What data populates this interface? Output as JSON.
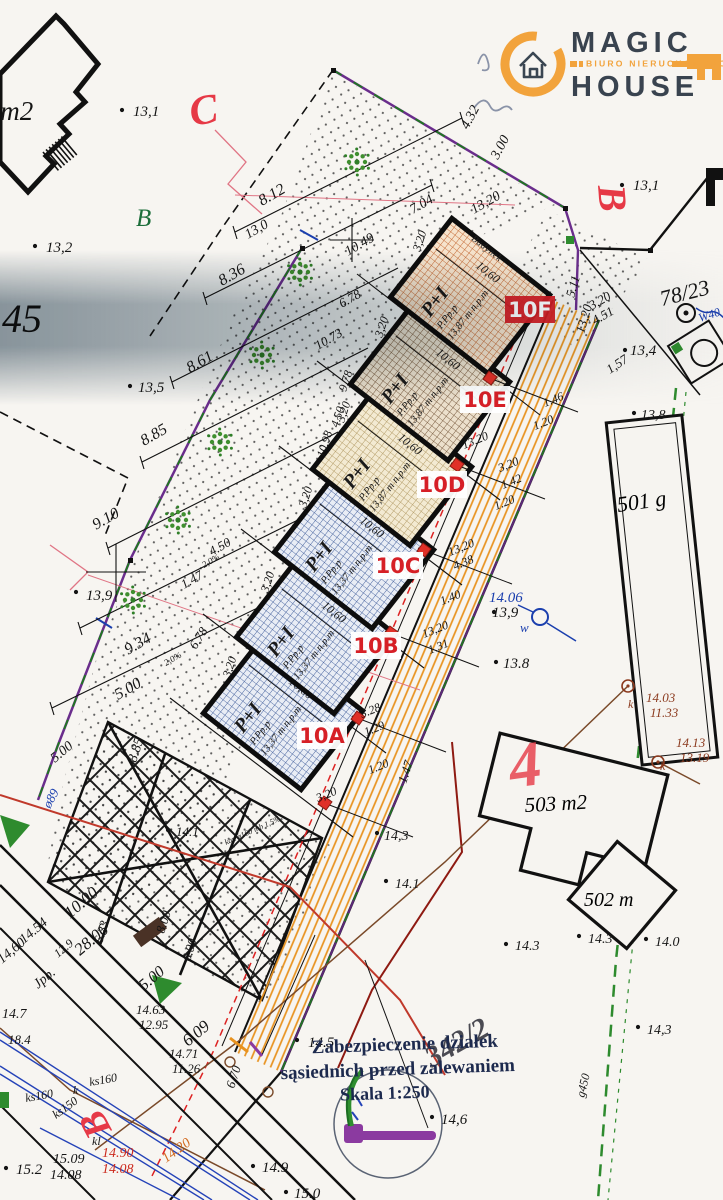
{
  "logo": {
    "word1": "MAGIC",
    "word2": "HOUSE",
    "tagline": "BIURO NIERUCHOMOŚCI"
  },
  "legend": {
    "line1": "Zabezpieczenie działek",
    "line2": "sąsiednich przed zalewaniem",
    "line3": "Skala 1:250"
  },
  "marker": "4",
  "buildings": {
    "b501": "501 g",
    "b503": "503 m2",
    "b502": "502 m"
  },
  "plot_common": {
    "storeys": "P+I",
    "code": "P.Pp.p",
    "building": "Budynek"
  },
  "plots": [
    {
      "id": "10A",
      "label": "10A",
      "cx": 283,
      "cy": 712,
      "pat": "blue",
      "elev": "13,37 m n.p.m",
      "depth": "10,60",
      "bx": 322,
      "by": 737,
      "ex": 325,
      "ey": 803,
      "inv": false
    },
    {
      "id": "10B",
      "label": "10B",
      "cx": 316,
      "cy": 636,
      "pat": "blue",
      "elev": "13,37 m n.p.m",
      "depth": "10,60",
      "bx": 376,
      "by": 647,
      "ex": 358,
      "ey": 718,
      "inv": false
    },
    {
      "id": "10C",
      "label": "10C",
      "cx": 354,
      "cy": 551,
      "pat": "blue",
      "elev": "13,37 m n.p.m",
      "depth": "10,60",
      "bx": 398,
      "by": 567,
      "ex": 391,
      "ey": 633,
      "inv": false
    },
    {
      "id": "10D",
      "label": "10D",
      "cx": 392,
      "cy": 468,
      "pat": "tan",
      "elev": "13,87 m n.p.m",
      "depth": "10,60",
      "bx": 442,
      "by": 486,
      "ex": 424,
      "ey": 550,
      "inv": false
    },
    {
      "id": "10E",
      "label": "10E",
      "cx": 430,
      "cy": 383,
      "pat": "brown",
      "elev": "13,87 m n.p.m",
      "depth": "10,60",
      "bx": 485,
      "by": 401,
      "ex": 457,
      "ey": 465,
      "inv": false
    },
    {
      "id": "10F",
      "label": "10F",
      "cx": 470,
      "cy": 296,
      "pat": "orange",
      "elev": "13,87 m n.p.m",
      "depth": "10,60",
      "bx": 530,
      "by": 311,
      "ex": 490,
      "ey": 378,
      "inv": true
    }
  ],
  "points": [
    [
      122,
      110
    ],
    [
      35,
      246
    ],
    [
      622,
      185
    ],
    [
      130,
      386
    ],
    [
      76,
      592
    ],
    [
      496,
      662
    ],
    [
      168,
      830
    ],
    [
      377,
      833
    ],
    [
      386,
      881
    ],
    [
      506,
      944
    ],
    [
      579,
      936
    ],
    [
      646,
      939
    ],
    [
      638,
      1027
    ],
    [
      297,
      1040
    ],
    [
      432,
      1117
    ],
    [
      253,
      1166
    ],
    [
      286,
      1192
    ],
    [
      6,
      1168
    ],
    [
      625,
      350
    ],
    [
      634,
      413
    ],
    [
      494,
      612
    ]
  ],
  "annotations": [
    {
      "t": "8 m2",
      "x": -20,
      "y": 120,
      "s": 27
    },
    {
      "t": "13,1",
      "x": 133,
      "y": 116,
      "s": 15
    },
    {
      "t": "C",
      "x": 192,
      "y": 126,
      "s": 42,
      "c": "#e63946",
      "r": -10,
      "b": 1
    },
    {
      "t": "B",
      "x": 136,
      "y": 226,
      "s": 25,
      "c": "#1c6e3a"
    },
    {
      "t": "13,2",
      "x": 46,
      "y": 252,
      "s": 15
    },
    {
      "t": "45",
      "x": 2,
      "y": 332,
      "s": 40
    },
    {
      "t": "8.12",
      "x": 262,
      "y": 206,
      "r": -30,
      "s": 16
    },
    {
      "t": "13,0",
      "x": 248,
      "y": 239,
      "r": -30,
      "s": 14
    },
    {
      "t": "10.49",
      "x": 348,
      "y": 256,
      "r": -30,
      "s": 14
    },
    {
      "t": "7.04",
      "x": 413,
      "y": 214,
      "r": -30,
      "s": 14
    },
    {
      "t": "13,20",
      "x": 474,
      "y": 214,
      "r": -30,
      "s": 14
    },
    {
      "t": "4.32",
      "x": 468,
      "y": 130,
      "r": -62,
      "s": 14
    },
    {
      "t": "3.00",
      "x": 498,
      "y": 160,
      "r": -62,
      "s": 14
    },
    {
      "t": "8.36",
      "x": 222,
      "y": 286,
      "r": -30,
      "s": 16
    },
    {
      "t": "6.78",
      "x": 342,
      "y": 308,
      "r": -30,
      "s": 13
    },
    {
      "t": "8.61",
      "x": 190,
      "y": 373,
      "r": -30,
      "s": 16
    },
    {
      "t": "10.73",
      "x": 318,
      "y": 350,
      "r": -30,
      "s": 13
    },
    {
      "t": "9.78",
      "x": 346,
      "y": 392,
      "r": -72,
      "s": 12
    },
    {
      "t": "4.50",
      "x": 338,
      "y": 428,
      "r": -72,
      "s": 12
    },
    {
      "t": "10.98",
      "x": 324,
      "y": 458,
      "r": -72,
      "s": 12
    },
    {
      "t": "8.85",
      "x": 144,
      "y": 446,
      "r": -30,
      "s": 16
    },
    {
      "t": "4.50",
      "x": 212,
      "y": 556,
      "r": -30,
      "s": 13
    },
    {
      "t": "1.47",
      "x": 184,
      "y": 589,
      "r": -30,
      "s": 13
    },
    {
      "t": "9.10",
      "x": 96,
      "y": 530,
      "r": -30,
      "s": 16
    },
    {
      "t": "13,9",
      "x": 86,
      "y": 600,
      "s": 15
    },
    {
      "t": "2,0%",
      "x": 204,
      "y": 568,
      "r": -30,
      "s": 9
    },
    {
      "t": "2,0%",
      "x": 166,
      "y": 666,
      "r": -30,
      "s": 9
    },
    {
      "t": "6.78",
      "x": 196,
      "y": 650,
      "r": -58,
      "s": 13
    },
    {
      "t": "9.34",
      "x": 128,
      "y": 655,
      "r": -30,
      "s": 16
    },
    {
      "t": "5.00",
      "x": 118,
      "y": 700,
      "r": -30,
      "s": 16
    },
    {
      "t": "13,5",
      "x": 138,
      "y": 392,
      "s": 15
    },
    {
      "t": "B",
      "x": 598,
      "y": 186,
      "s": 40,
      "c": "#e63946",
      "r": 85,
      "b": 1
    },
    {
      "t": "13,1",
      "x": 633,
      "y": 190,
      "s": 15
    },
    {
      "t": "78/23",
      "x": 662,
      "y": 306,
      "r": -14,
      "s": 22
    },
    {
      "t": "W40",
      "x": 700,
      "y": 322,
      "r": -18,
      "s": 12,
      "c": "#1b3fae"
    },
    {
      "t": "5.11",
      "x": 574,
      "y": 298,
      "r": -74,
      "s": 13
    },
    {
      "t": "13,20",
      "x": 584,
      "y": 334,
      "r": -74,
      "s": 13
    },
    {
      "t": "3,20",
      "x": 592,
      "y": 310,
      "r": -30,
      "s": 13
    },
    {
      "t": "4.51",
      "x": 595,
      "y": 325,
      "r": -30,
      "s": 13
    },
    {
      "t": "13,4",
      "x": 630,
      "y": 355,
      "s": 15
    },
    {
      "t": "1,57",
      "x": 610,
      "y": 374,
      "r": -34,
      "s": 13
    },
    {
      "t": "13,8",
      "x": 641,
      "y": 419,
      "s": 14
    },
    {
      "t": "1.46",
      "x": 545,
      "y": 407,
      "r": -22,
      "s": 12
    },
    {
      "t": "1.20",
      "x": 535,
      "y": 430,
      "r": -22,
      "s": 12
    },
    {
      "t": "13,20",
      "x": 464,
      "y": 449,
      "r": -22,
      "s": 12
    },
    {
      "t": "3,20",
      "x": 500,
      "y": 472,
      "r": -22,
      "s": 12
    },
    {
      "t": "1.42",
      "x": 503,
      "y": 489,
      "r": -22,
      "s": 12
    },
    {
      "t": "1.20",
      "x": 496,
      "y": 510,
      "r": -22,
      "s": 12
    },
    {
      "t": "13,20",
      "x": 450,
      "y": 556,
      "r": -22,
      "s": 12
    },
    {
      "t": "4.38",
      "x": 455,
      "y": 570,
      "r": -22,
      "s": 12
    },
    {
      "t": "1.40",
      "x": 442,
      "y": 605,
      "r": -22,
      "s": 12
    },
    {
      "t": "13,20",
      "x": 424,
      "y": 638,
      "r": -22,
      "s": 12
    },
    {
      "t": "1.31",
      "x": 430,
      "y": 654,
      "r": -22,
      "s": 12
    },
    {
      "t": "3.28",
      "x": 362,
      "y": 718,
      "r": -22,
      "s": 12
    },
    {
      "t": "1.29",
      "x": 366,
      "y": 736,
      "r": -22,
      "s": 12
    },
    {
      "t": "1.20",
      "x": 370,
      "y": 774,
      "r": -22,
      "s": 12
    },
    {
      "t": "1.47",
      "x": 406,
      "y": 784,
      "r": -72,
      "s": 13
    },
    {
      "t": "3,20",
      "x": 318,
      "y": 802,
      "r": -22,
      "s": 12
    },
    {
      "t": "3,20",
      "x": 420,
      "y": 252,
      "r": -72,
      "s": 12
    },
    {
      "t": "3,20",
      "x": 382,
      "y": 338,
      "r": -72,
      "s": 12
    },
    {
      "t": "3,20",
      "x": 344,
      "y": 423,
      "r": -72,
      "s": 12
    },
    {
      "t": "3,20",
      "x": 306,
      "y": 508,
      "r": -72,
      "s": 12
    },
    {
      "t": "3,20",
      "x": 268,
      "y": 593,
      "r": -72,
      "s": 12
    },
    {
      "t": "3,20",
      "x": 230,
      "y": 678,
      "r": -72,
      "s": 12
    },
    {
      "t": "14.06",
      "x": 489,
      "y": 602,
      "s": 15,
      "c": "#1b3fae"
    },
    {
      "t": "13,9",
      "x": 492,
      "y": 617,
      "s": 15
    },
    {
      "t": "w",
      "x": 520,
      "y": 632,
      "s": 13,
      "c": "#1b3fae"
    },
    {
      "t": "13.8",
      "x": 503,
      "y": 668,
      "s": 15
    },
    {
      "t": "14.03",
      "x": 646,
      "y": 702,
      "s": 13,
      "c": "#8b3a1e"
    },
    {
      "t": "11.33",
      "x": 650,
      "y": 717,
      "s": 13,
      "c": "#8b3a1e"
    },
    {
      "t": "k",
      "x": 628,
      "y": 708,
      "s": 12,
      "c": "#8b3a1e"
    },
    {
      "t": "14.13",
      "x": 676,
      "y": 747,
      "s": 13,
      "c": "#8b3a1e"
    },
    {
      "t": "13.19",
      "x": 680,
      "y": 762,
      "s": 13,
      "c": "#8b3a1e"
    },
    {
      "t": "k",
      "x": 660,
      "y": 770,
      "s": 12,
      "c": "#8b3a1e"
    },
    {
      "t": "14,3",
      "x": 384,
      "y": 840,
      "s": 14
    },
    {
      "t": "14.1",
      "x": 395,
      "y": 888,
      "s": 14
    },
    {
      "t": "14.3",
      "x": 515,
      "y": 950,
      "s": 14
    },
    {
      "t": "14.3",
      "x": 588,
      "y": 943,
      "s": 14
    },
    {
      "t": "14.0",
      "x": 655,
      "y": 946,
      "s": 14
    },
    {
      "t": "14,3",
      "x": 647,
      "y": 1034,
      "s": 14
    },
    {
      "t": "14.5",
      "x": 308,
      "y": 1047,
      "s": 15
    },
    {
      "t": "14,6",
      "x": 441,
      "y": 1124,
      "s": 15
    },
    {
      "t": "14.9",
      "x": 262,
      "y": 1172,
      "s": 15
    },
    {
      "t": "15.0",
      "x": 294,
      "y": 1198,
      "s": 15
    },
    {
      "t": "g450",
      "x": 584,
      "y": 1098,
      "r": -76,
      "s": 12
    },
    {
      "t": "10.00",
      "x": 70,
      "y": 919,
      "r": -40,
      "s": 17
    },
    {
      "t": "28.06",
      "x": 80,
      "y": 956,
      "r": -40,
      "s": 17
    },
    {
      "t": "6.23",
      "x": 102,
      "y": 944,
      "r": -72,
      "s": 13
    },
    {
      "t": "14.54",
      "x": 24,
      "y": 944,
      "r": -40,
      "s": 14
    },
    {
      "t": "12.9",
      "x": 58,
      "y": 958,
      "r": -40,
      "s": 12
    },
    {
      "t": "14,60",
      "x": 2,
      "y": 964,
      "r": -40,
      "s": 14
    },
    {
      "t": "Jpb.",
      "x": 38,
      "y": 989,
      "r": -40,
      "s": 14
    },
    {
      "t": "14.7",
      "x": 2,
      "y": 1018,
      "s": 14
    },
    {
      "t": "18.4",
      "x": 8,
      "y": 1044,
      "s": 13
    },
    {
      "t": "8.00",
      "x": 164,
      "y": 934,
      "r": -72,
      "s": 13
    },
    {
      "t": "6.00",
      "x": 190,
      "y": 962,
      "r": -72,
      "s": 13
    },
    {
      "t": "5.00",
      "x": 144,
      "y": 991,
      "r": -40,
      "s": 16
    },
    {
      "t": "6.09",
      "x": 188,
      "y": 1047,
      "r": -40,
      "s": 17
    },
    {
      "t": "6.70",
      "x": 234,
      "y": 1089,
      "r": -72,
      "s": 13
    },
    {
      "t": "14.63",
      "x": 136,
      "y": 1014,
      "s": 13
    },
    {
      "t": "12.95",
      "x": 139,
      "y": 1029,
      "s": 13
    },
    {
      "t": "14.71",
      "x": 169,
      "y": 1058,
      "s": 13
    },
    {
      "t": "11.26",
      "x": 172,
      "y": 1073,
      "s": 13
    },
    {
      "t": "ks160",
      "x": 26,
      "y": 1102,
      "r": -10,
      "s": 12
    },
    {
      "t": "k",
      "x": 73,
      "y": 1094,
      "s": 12
    },
    {
      "t": "ks160",
      "x": 90,
      "y": 1086,
      "r": -10,
      "s": 12
    },
    {
      "t": "ks150",
      "x": 56,
      "y": 1119,
      "r": -36,
      "s": 12
    },
    {
      "t": "kl",
      "x": 92,
      "y": 1145,
      "s": 12
    },
    {
      "t": "15.09",
      "x": 53,
      "y": 1163,
      "s": 14
    },
    {
      "t": "14.08",
      "x": 50,
      "y": 1179,
      "s": 14
    },
    {
      "t": "14.90",
      "x": 102,
      "y": 1157,
      "s": 14,
      "c": "#cc2a1e"
    },
    {
      "t": "14.08",
      "x": 102,
      "y": 1173,
      "s": 14,
      "c": "#cc2a1e"
    },
    {
      "t": "14.20",
      "x": 166,
      "y": 1163,
      "r": -36,
      "s": 14,
      "c": "#d2691e"
    },
    {
      "t": "B",
      "x": 112,
      "y": 1130,
      "s": 38,
      "c": "#e63946",
      "r": -118,
      "b": 1
    },
    {
      "t": "ø89",
      "x": 50,
      "y": 809,
      "r": -62,
      "s": 13,
      "c": "#1b3fae"
    },
    {
      "t": "5.00",
      "x": 55,
      "y": 763,
      "r": -40,
      "s": 14
    },
    {
      "t": "8.85",
      "x": 136,
      "y": 763,
      "r": -72,
      "s": 14
    },
    {
      "t": "14.1",
      "x": 176,
      "y": 836,
      "s": 13
    },
    {
      "t": "kan ø160 mb 1,5%",
      "x": 226,
      "y": 845,
      "r": -24,
      "s": 8
    },
    {
      "t": "15.2",
      "x": 16,
      "y": 1174,
      "s": 15
    },
    {
      "t": "342/2",
      "x": 432,
      "y": 1068,
      "r": -30,
      "s": 30,
      "c": "#4a4a52",
      "b": 1
    }
  ],
  "colors": {
    "plot_label_red": "#d61f26",
    "boundary_purple": "#6a2d8c",
    "road_orange": "#e8921e",
    "logo_orange": "#f2a33c",
    "logo_navy": "#39434f"
  }
}
